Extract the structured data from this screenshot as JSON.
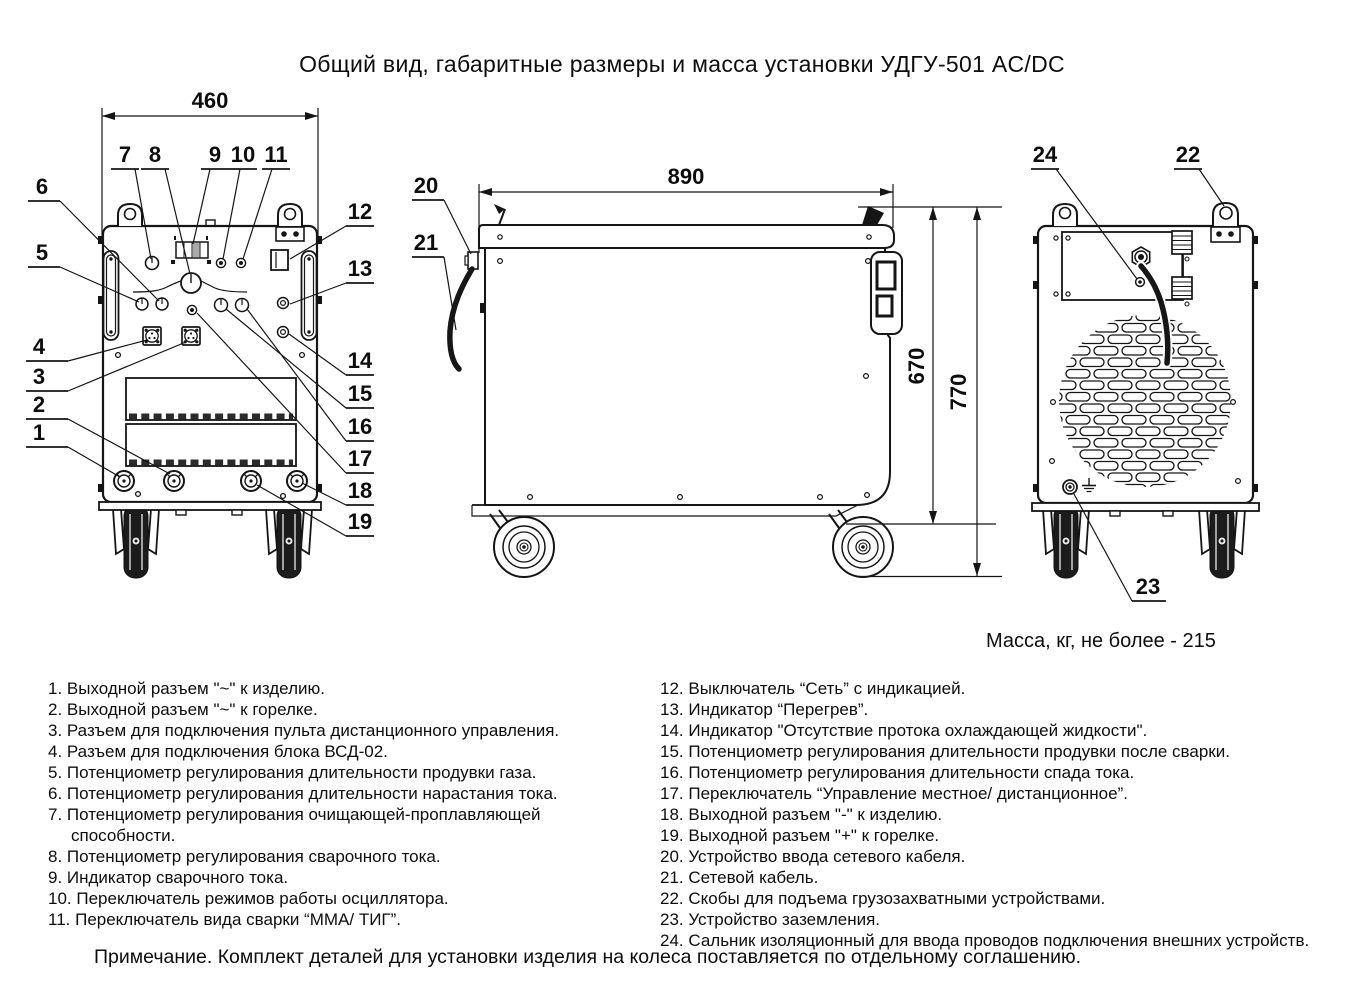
{
  "title": "Общий вид, габаритные размеры и масса установки УДГУ-501 AC/DC",
  "mass_note": "Масса, кг, не более - 215",
  "footer_note": "Примечание. Комплект деталей для установки изделия на колеса поставляется по отдельному соглашению.",
  "dimensions": {
    "front_width": "460",
    "side_depth": "890",
    "body_height": "670",
    "total_height": "770"
  },
  "callouts": {
    "c1": "1",
    "c2": "2",
    "c3": "3",
    "c4": "4",
    "c5": "5",
    "c6": "6",
    "c7": "7",
    "c8": "8",
    "c9": "9",
    "c10": "10",
    "c11": "11",
    "c12": "12",
    "c13": "13",
    "c14": "14",
    "c15": "15",
    "c16": "16",
    "c17": "17",
    "c18": "18",
    "c19": "19",
    "c20": "20",
    "c21": "21",
    "c22": "22",
    "c23": "23",
    "c24": "24"
  },
  "legend_left": [
    "1. Выходной разъем \"~\" к изделию.",
    "2. Выходной разъем \"~\" к горелке.",
    "3. Разъем для подключения пульта дистанционного управления.",
    "4. Разъем для подключения блока ВСД-02.",
    "5. Потенциометр регулирования длительности продувки газа.",
    "6. Потенциометр регулирования длительности нарастания тока.",
    "7. Потенциометр регулирования очищающей-проплавляющей способности.",
    "8. Потенциометр регулирования сварочного тока.",
    "9. Индикатор сварочного тока.",
    "10. Переключатель режимов работы осциллятора.",
    "11. Переключатель вида сварки “ММА/ ТИГ”."
  ],
  "legend_right": [
    "12. Выключатель “Сеть” с индикацией.",
    "13. Индикатор “Перегрев”.",
    "14. Индикатор \"Отсутствие протока охлаждающей жидкости\".",
    "15. Потенциометр регулирования длительности продувки после сварки.",
    "16. Потенциометр регулирования длительности спада тока.",
    "17. Переключатель “Управление местное/ дистанционное”.",
    "18. Выходной разъем \"-\" к изделию.",
    "19. Выходной разъем \"+\" к горелке.",
    "20. Устройство ввода сетевого кабеля.",
    "21. Сетевой кабель.",
    "22. Скобы для подъема грузозахватными устройствами.",
    "23. Устройство заземления.",
    "24. Сальник изоляционный для ввода проводов подключения внешних устройств."
  ]
}
